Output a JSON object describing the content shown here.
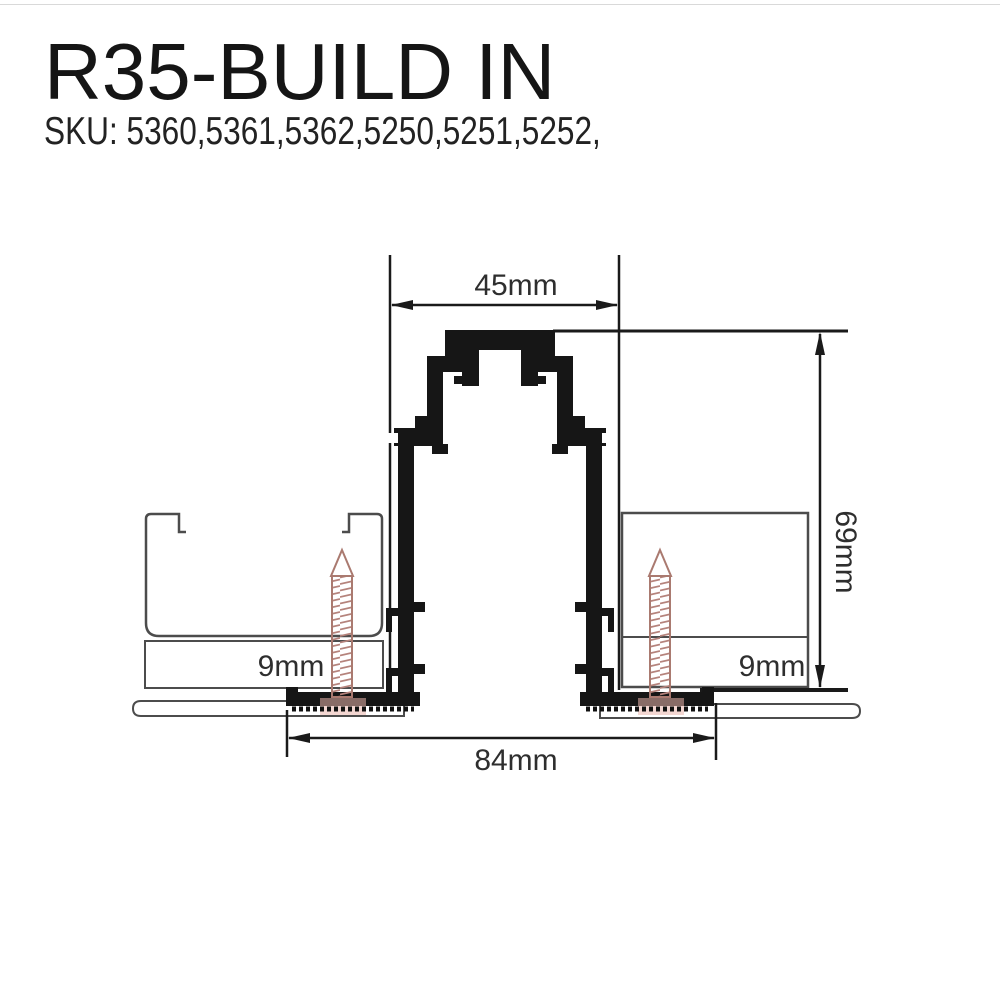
{
  "header": {
    "title": "R35-BUILD IN",
    "sku": "SKU: 5360,5361,5362,5250,5251,5252,"
  },
  "diagram": {
    "dimensions": {
      "top_width": "45mm",
      "height": "69mm",
      "board_left": "9mm",
      "board_right": "9mm",
      "bottom_width": "84mm"
    },
    "colors": {
      "profile_black": "#161616",
      "construction_gray": "#4c4c4c",
      "screw_thread": "#b5837c",
      "screw_outline": "#aa7a70",
      "screw_glow": "#eab5ac",
      "dimension_text": "#2e2e2e"
    }
  }
}
